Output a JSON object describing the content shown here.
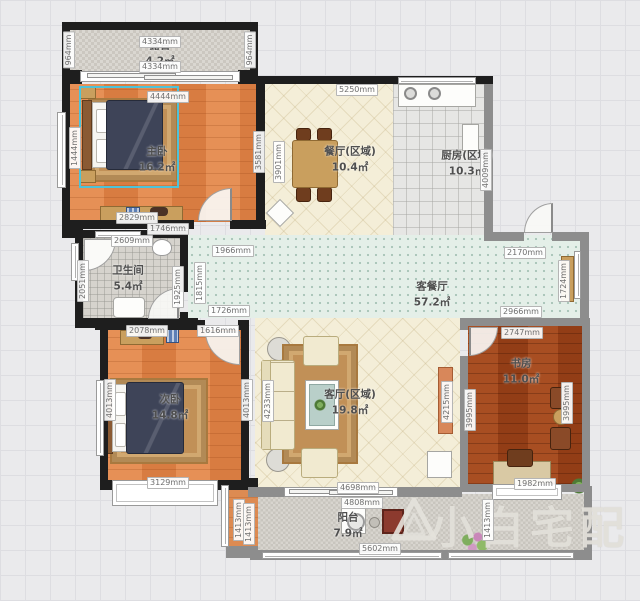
{
  "rooms": {
    "terrace": {
      "label": "露台",
      "area": "4.2㎡"
    },
    "master": {
      "label": "主卧",
      "area": "16.2㎡"
    },
    "dining": {
      "label": "餐厅(区域)",
      "area": "10.4㎡"
    },
    "kitchen": {
      "label": "厨房(区域)",
      "area": "10.3㎡"
    },
    "bath": {
      "label": "卫生间",
      "area": "5.4㎡"
    },
    "hall": {
      "label": "客餐厅",
      "area": "57.2㎡"
    },
    "bed2": {
      "label": "次卧",
      "area": "14.8㎡"
    },
    "living": {
      "label": "客厅(区域)",
      "area": "19.8㎡"
    },
    "study": {
      "label": "书房",
      "area": "11.0㎡"
    },
    "balcony": {
      "label": "阳台",
      "area": "7.9㎡"
    }
  },
  "watermark": {
    "text": "小白宅配"
  },
  "dimensions": [
    {
      "t": "4334mm",
      "x": 160,
      "y": 42,
      "r": 0
    },
    {
      "t": "4334mm",
      "x": 160,
      "y": 67,
      "r": 0
    },
    {
      "t": "964mm",
      "x": 69,
      "y": 50,
      "r": 1
    },
    {
      "t": "964mm",
      "x": 250,
      "y": 50,
      "r": 1
    },
    {
      "t": "4444mm",
      "x": 168,
      "y": 97,
      "r": 0
    },
    {
      "t": "1444mm",
      "x": 75,
      "y": 148,
      "r": 1
    },
    {
      "t": "3581mm",
      "x": 259,
      "y": 152,
      "r": 1
    },
    {
      "t": "2829mm",
      "x": 137,
      "y": 218,
      "r": 0
    },
    {
      "t": "1746mm",
      "x": 168,
      "y": 229,
      "r": 0
    },
    {
      "t": "5250mm",
      "x": 357,
      "y": 90,
      "r": 0
    },
    {
      "t": "3901mm",
      "x": 279,
      "y": 162,
      "r": 1
    },
    {
      "t": "4009mm",
      "x": 486,
      "y": 170,
      "r": 1
    },
    {
      "t": "2609mm",
      "x": 132,
      "y": 241,
      "r": 0
    },
    {
      "t": "2051mm",
      "x": 83,
      "y": 281,
      "r": 1
    },
    {
      "t": "1925mm",
      "x": 178,
      "y": 287,
      "r": 1
    },
    {
      "t": "1966mm",
      "x": 233,
      "y": 251,
      "r": 0
    },
    {
      "t": "1815mm",
      "x": 200,
      "y": 283,
      "r": 1
    },
    {
      "t": "1726mm",
      "x": 229,
      "y": 311,
      "r": 0
    },
    {
      "t": "2170mm",
      "x": 525,
      "y": 253,
      "r": 0
    },
    {
      "t": "1724mm",
      "x": 564,
      "y": 281,
      "r": 1
    },
    {
      "t": "2966mm",
      "x": 521,
      "y": 312,
      "r": 0
    },
    {
      "t": "2078mm",
      "x": 147,
      "y": 331,
      "r": 0
    },
    {
      "t": "1616mm",
      "x": 218,
      "y": 331,
      "r": 0
    },
    {
      "t": "4013mm",
      "x": 110,
      "y": 400,
      "r": 1
    },
    {
      "t": "4013mm",
      "x": 247,
      "y": 400,
      "r": 1
    },
    {
      "t": "3129mm",
      "x": 168,
      "y": 483,
      "r": 0
    },
    {
      "t": "4233mm",
      "x": 268,
      "y": 401,
      "r": 1
    },
    {
      "t": "4215mm",
      "x": 447,
      "y": 402,
      "r": 1
    },
    {
      "t": "4698mm",
      "x": 358,
      "y": 488,
      "r": 0
    },
    {
      "t": "2747mm",
      "x": 522,
      "y": 333,
      "r": 0
    },
    {
      "t": "3995mm",
      "x": 470,
      "y": 410,
      "r": 1
    },
    {
      "t": "3995mm",
      "x": 567,
      "y": 403,
      "r": 1
    },
    {
      "t": "1982mm",
      "x": 535,
      "y": 484,
      "r": 0
    },
    {
      "t": "4808mm",
      "x": 362,
      "y": 503,
      "r": 0
    },
    {
      "t": "5602mm",
      "x": 380,
      "y": 549,
      "r": 0
    },
    {
      "t": "1413mm",
      "x": 488,
      "y": 520,
      "r": 1
    },
    {
      "t": "1413mm",
      "x": 239,
      "y": 520,
      "r": 1
    },
    {
      "t": "1413mm",
      "x": 249,
      "y": 524,
      "r": 1
    }
  ]
}
